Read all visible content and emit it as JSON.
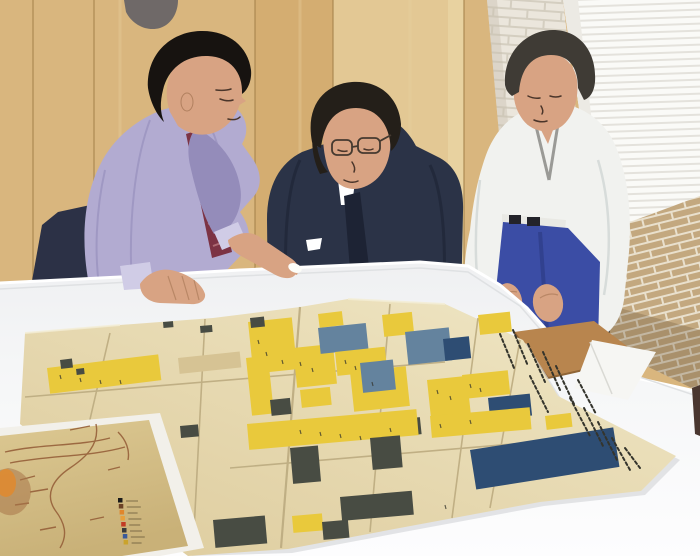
{
  "scene": {
    "description": "Three men stand around a large white table examining antique folded Japanese castle-town maps; an older sepia chart with a small color legend lies at the lower left.",
    "figures": [
      {
        "id": "left",
        "label": "man in lavender shirt and striped tie pointing at the map"
      },
      {
        "id": "middle",
        "label": "man in dark navy suit with glasses leaning over the table"
      },
      {
        "id": "right",
        "label": "man in white shinto robe with blue hakama, hands on knees"
      }
    ],
    "objects": [
      {
        "id": "big-map",
        "label": "large folded cream map with yellow, slate and indigo parcels and calligraphy columns"
      },
      {
        "id": "sepia-map",
        "label": "sepia coastal map with brown linework and small color-key legend"
      },
      {
        "id": "table",
        "label": "white meeting table"
      },
      {
        "id": "chair",
        "label": "wooden chair seat beyond table edge"
      },
      {
        "id": "wall",
        "label": "light wood panel wall, white brick pillar, bright window with blinds, tan brick wall"
      }
    ]
  },
  "colors": {
    "wood": "#d9b67e",
    "wood_light": "#e3c894",
    "wood_dark": "#cfa566",
    "wood_seam": "#a8854e",
    "wood_grain": "#e8d1a0",
    "blob_grey": "#5c5c64",
    "pillar_brick": "#ebe6dc",
    "pillar_mortar": "#d4cec0",
    "window": "#fafaf7",
    "blind": "#e4e2dc",
    "brick": "#c3a87f",
    "brick_mortar": "#e9e0cd",
    "brick_shade": "#6e5940",
    "dark_strip": "#2e2e33",
    "table_top": "#f1f2f3",
    "table_front": "#fdfdfe",
    "table_shadow": "#d7d9db",
    "table_edge_dark": "#4a3730",
    "chair_wood": "#b8854e",
    "chair_edge": "#8f6436",
    "paper_white": "#f6f6f3",
    "white_sheet": "#f2f0ea",
    "paper_hi": "#f0e7c6",
    "paper_lo": "#ddcb9c",
    "paper_tan": "#d6c394",
    "crease": "#bcab80",
    "map_yellow": "#e9c93c",
    "map_dark": "#484c43",
    "map_navy": "#2e4d73",
    "map_bluegrey": "#64839e",
    "ink": "#34342c",
    "sepia_hi": "#dcc892",
    "sepia_lo": "#c9b178",
    "sepia_line": "#96603a",
    "sepia_orange": "#e08a2e",
    "sepia_cluster": "#a87448",
    "legend_text": "#6a5a3a",
    "skin": "#d8a383",
    "skin_shadow": "#b1805f",
    "face_line": "#4a352a",
    "hair_black": "#171310",
    "hair_brown": "#241f19",
    "hair_grey": "#3f3b35",
    "shirt": "#b2abd1",
    "shirt_shade": "#948cba",
    "trousers": "#2c3146",
    "tie": "#7c3344",
    "tie_stripe": "#bb7a80",
    "suit": "#2b3347",
    "suit_dark": "#1d2334",
    "glasses": "#453a30",
    "kimono": "#f1f2ef",
    "kimono_shade": "#d5dad8",
    "hakama": "#3b4da5",
    "hakama_dark": "#2e3c86",
    "cuff": "#d0cce6",
    "pointer": "#fdfdf8"
  },
  "map_blocks": [
    {
      "x": 178,
      "y": 358,
      "w": 62,
      "h": 16,
      "r": -6,
      "c": "tan"
    },
    {
      "x": 47,
      "y": 368,
      "w": 112,
      "h": 26,
      "r": -7,
      "c": "yellow"
    },
    {
      "x": 60,
      "y": 360,
      "w": 12,
      "h": 9,
      "r": -7,
      "c": "dark"
    },
    {
      "x": 76,
      "y": 369,
      "w": 8,
      "h": 6,
      "r": -7,
      "c": "dark"
    },
    {
      "x": 163,
      "y": 322,
      "w": 10,
      "h": 6,
      "r": -5,
      "c": "dark"
    },
    {
      "x": 200,
      "y": 326,
      "w": 12,
      "h": 7,
      "r": -5,
      "c": "dark"
    },
    {
      "x": 180,
      "y": 426,
      "w": 18,
      "h": 12,
      "r": -5,
      "c": "dark"
    },
    {
      "x": 246,
      "y": 358,
      "w": 22,
      "h": 58,
      "r": -6,
      "c": "yellow"
    },
    {
      "x": 248,
      "y": 322,
      "w": 44,
      "h": 52,
      "r": -6,
      "c": "yellow"
    },
    {
      "x": 250,
      "y": 318,
      "w": 14,
      "h": 10,
      "r": -6,
      "c": "dark"
    },
    {
      "x": 318,
      "y": 314,
      "w": 24,
      "h": 14,
      "r": -7,
      "c": "yellow"
    },
    {
      "x": 293,
      "y": 348,
      "w": 40,
      "h": 40,
      "r": -6,
      "c": "yellow"
    },
    {
      "x": 318,
      "y": 328,
      "w": 48,
      "h": 26,
      "r": -6,
      "c": "bluegrey"
    },
    {
      "x": 335,
      "y": 352,
      "w": 50,
      "h": 24,
      "r": -6,
      "c": "yellow"
    },
    {
      "x": 382,
      "y": 315,
      "w": 30,
      "h": 22,
      "r": -6,
      "c": "yellow"
    },
    {
      "x": 405,
      "y": 332,
      "w": 44,
      "h": 33,
      "r": -6,
      "c": "bluegrey"
    },
    {
      "x": 443,
      "y": 339,
      "w": 26,
      "h": 22,
      "r": -6,
      "c": "navy"
    },
    {
      "x": 478,
      "y": 315,
      "w": 32,
      "h": 20,
      "r": -6,
      "c": "yellow"
    },
    {
      "x": 350,
      "y": 372,
      "w": 56,
      "h": 40,
      "r": -6,
      "c": "yellow"
    },
    {
      "x": 360,
      "y": 363,
      "w": 33,
      "h": 30,
      "r": -6,
      "c": "bluegrey"
    },
    {
      "x": 427,
      "y": 380,
      "w": 40,
      "h": 40,
      "r": -6,
      "c": "yellow"
    },
    {
      "x": 462,
      "y": 375,
      "w": 46,
      "h": 24,
      "r": -6,
      "c": "yellow"
    },
    {
      "x": 488,
      "y": 398,
      "w": 42,
      "h": 22,
      "r": -6,
      "c": "navy"
    },
    {
      "x": 393,
      "y": 420,
      "w": 27,
      "h": 17,
      "r": -6,
      "c": "dark"
    },
    {
      "x": 270,
      "y": 400,
      "w": 20,
      "h": 16,
      "r": -6,
      "c": "dark"
    },
    {
      "x": 300,
      "y": 390,
      "w": 30,
      "h": 18,
      "r": -6,
      "c": "yellow"
    },
    {
      "x": 247,
      "y": 424,
      "w": 170,
      "h": 26,
      "r": -5,
      "c": "yellow"
    },
    {
      "x": 430,
      "y": 416,
      "w": 100,
      "h": 22,
      "r": -5,
      "c": "yellow"
    },
    {
      "x": 290,
      "y": 448,
      "w": 28,
      "h": 36,
      "r": -5,
      "c": "dark"
    },
    {
      "x": 370,
      "y": 438,
      "w": 30,
      "h": 32,
      "r": -5,
      "c": "dark"
    },
    {
      "x": 555,
      "y": 438,
      "w": 28,
      "h": 16,
      "r": -7,
      "c": "yellow"
    },
    {
      "x": 545,
      "y": 416,
      "w": 26,
      "h": 14,
      "r": -7,
      "c": "yellow"
    },
    {
      "x": 470,
      "y": 450,
      "w": 145,
      "h": 40,
      "r": -9,
      "c": "navy"
    },
    {
      "x": 213,
      "y": 520,
      "w": 52,
      "h": 28,
      "r": -5,
      "c": "dark"
    },
    {
      "x": 340,
      "y": 497,
      "w": 72,
      "h": 24,
      "r": -5,
      "c": "dark"
    },
    {
      "x": 292,
      "y": 516,
      "w": 30,
      "h": 17,
      "r": -5,
      "c": "yellow"
    },
    {
      "x": 322,
      "y": 522,
      "w": 26,
      "h": 18,
      "r": -5,
      "c": "dark"
    }
  ],
  "calligraphy": [
    [
      500,
      334,
      514,
      368
    ],
    [
      513,
      330,
      528,
      366
    ],
    [
      528,
      344,
      545,
      382
    ],
    [
      543,
      352,
      560,
      390
    ],
    [
      530,
      376,
      548,
      412
    ],
    [
      556,
      366,
      574,
      404
    ],
    [
      578,
      380,
      596,
      414
    ],
    [
      570,
      398,
      590,
      436
    ],
    [
      584,
      408,
      604,
      448
    ],
    [
      598,
      422,
      618,
      462
    ],
    [
      612,
      438,
      630,
      470
    ],
    [
      625,
      448,
      640,
      468
    ]
  ],
  "ink_marks": [
    [
      60,
      375
    ],
    [
      80,
      378
    ],
    [
      100,
      380
    ],
    [
      120,
      380
    ],
    [
      258,
      340
    ],
    [
      266,
      352
    ],
    [
      282,
      360
    ],
    [
      300,
      362
    ],
    [
      312,
      368
    ],
    [
      345,
      360
    ],
    [
      355,
      366
    ],
    [
      372,
      382
    ],
    [
      437,
      390
    ],
    [
      450,
      396
    ],
    [
      470,
      384
    ],
    [
      480,
      388
    ],
    [
      300,
      430
    ],
    [
      320,
      432
    ],
    [
      340,
      434
    ],
    [
      360,
      436
    ],
    [
      390,
      428
    ],
    [
      440,
      424
    ],
    [
      470,
      420
    ],
    [
      445,
      505
    ]
  ],
  "sepia_legend": {
    "swatches": [
      "#1a1a1a",
      "#6b4226",
      "#e0862c",
      "#e8a03c",
      "#c23b24",
      "#3a3a3a",
      "#3a5a9a",
      "#caa32c"
    ],
    "line_lengths": [
      12,
      14,
      10,
      13,
      11,
      12,
      14,
      10
    ]
  }
}
